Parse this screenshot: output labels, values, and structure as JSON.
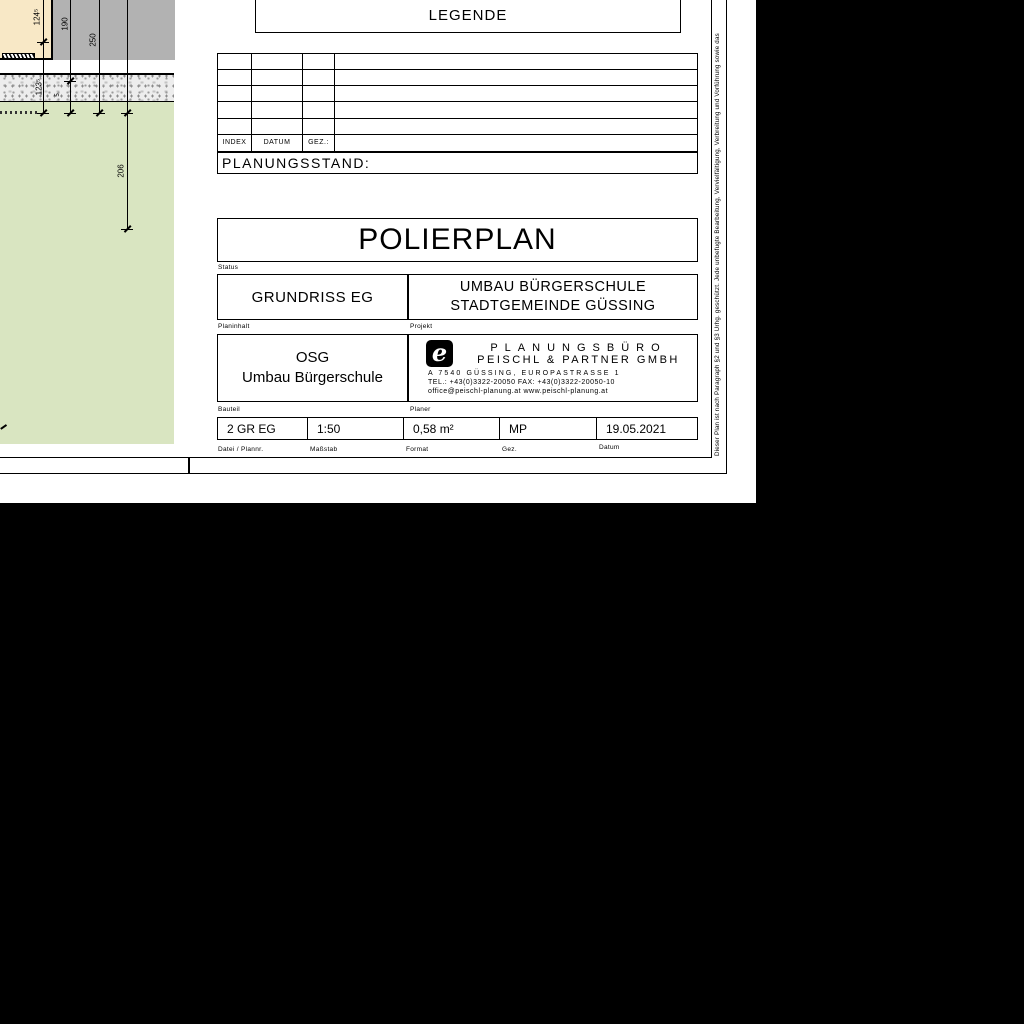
{
  "legend": {
    "title": "LEGENDE"
  },
  "index_table": {
    "headers": [
      "INDEX",
      "DATUM",
      "GEZ.:"
    ],
    "empty_rows": 5
  },
  "planungsstand": {
    "label": "PLANUNGSSTAND:"
  },
  "title_block": {
    "plan_type": "POLIERPLAN",
    "status_label": "Status",
    "plan_content": "GRUNDRISS EG",
    "plan_content_label": "Planinhalt",
    "project_line1": "UMBAU BÜRGERSCHULE",
    "project_line2": "STADTGEMEINDE GÜSSING",
    "project_label": "Projekt",
    "bauteil_line1": "OSG",
    "bauteil_line2": "Umbau Bürgerschule",
    "bauteil_label": "Bauteil",
    "planer_label": "Planer",
    "firm": {
      "logo_glyph": "e",
      "name_line1": "PLANUNGSBÜRO",
      "name_line2": "PEISCHL & PARTNER GMBH",
      "address": "A 7540 GÜSSING, EUROPASTRASSE 1",
      "phone": "TEL.: +43(0)3322-20050  FAX: +43(0)3322-20050-10",
      "web": "office@peischl-planung.at  www.peischl-planung.at"
    },
    "meta": {
      "file": {
        "value": "2 GR EG",
        "label": "Datei / Plannr."
      },
      "scale": {
        "value": "1:50",
        "label": "Maßstab"
      },
      "format": {
        "value": "0,58 m²",
        "label": "Format"
      },
      "gez": {
        "value": "MP",
        "label": "Gez."
      },
      "datum": {
        "value": "19.05.2021",
        "label": "Datum"
      }
    }
  },
  "copyright_strip": "Dieser Plan ist nach Paragraph §2 und §3 Urhg. geschützt. Jede unbefugte Bearbeitung, Vervielfältigung, Verbreitung und Vorführung sowie das",
  "drawing": {
    "dim_labels": [
      "124⁵",
      "190",
      "250",
      "123⁵",
      "5",
      "206"
    ],
    "colors": {
      "wall": "#f8e8c6",
      "concrete": "#b2b2b2",
      "gravel": "#ededed",
      "ground": "#d9e5c1"
    }
  }
}
